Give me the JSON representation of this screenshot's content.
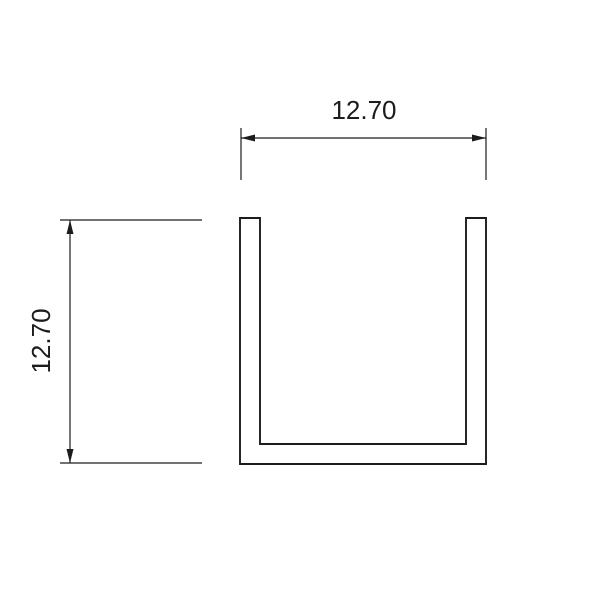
{
  "page": {
    "background": "#ffffff"
  },
  "drawing": {
    "kind": "technical-drawing-cross-section",
    "line_color": "#1c1c1c",
    "dimensions": {
      "width_label": "12.70",
      "height_label": "12.70"
    }
  }
}
